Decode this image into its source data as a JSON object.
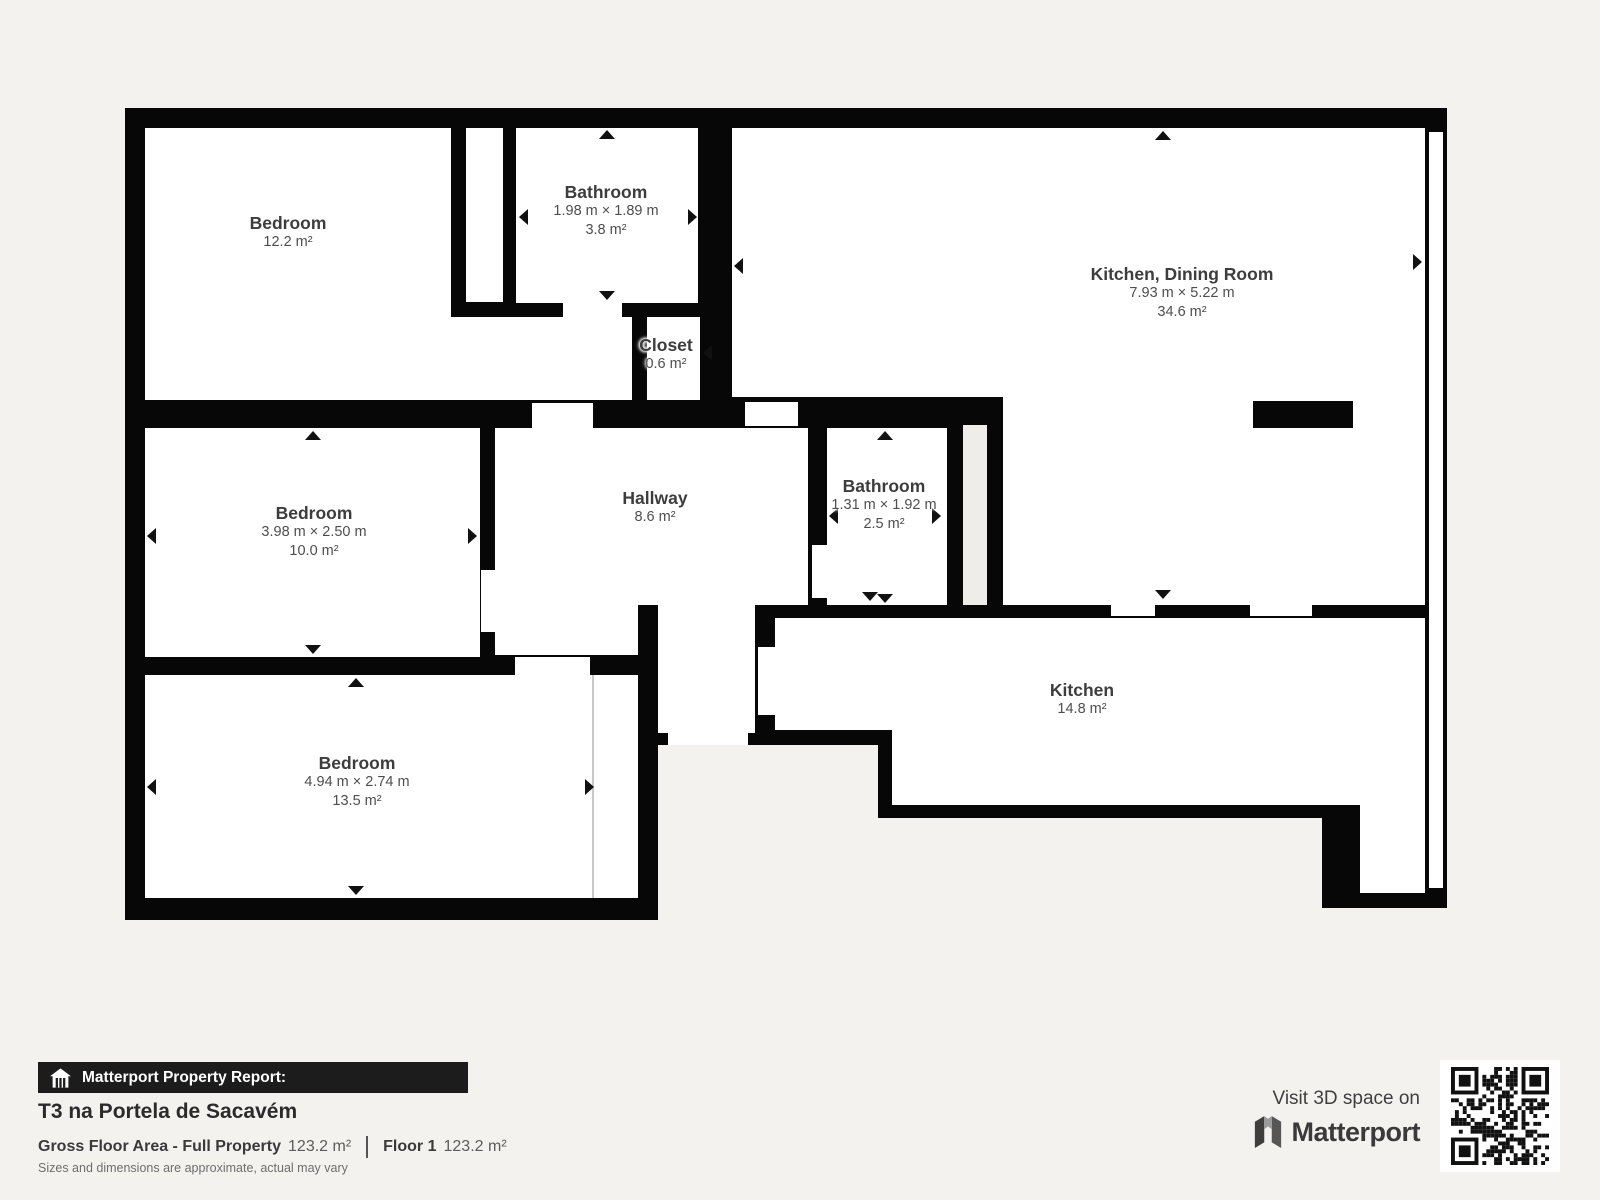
{
  "plan": {
    "rooms": {
      "bedroom_top": {
        "name": "Bedroom",
        "area": "12.2 m²"
      },
      "bathroom_top": {
        "name": "Bathroom",
        "dims": "1.98 m × 1.89 m",
        "area": "3.8 m²"
      },
      "kitchen_dining": {
        "name": "Kitchen, Dining Room",
        "dims": "7.93 m × 5.22 m",
        "area": "34.6 m²"
      },
      "closet": {
        "name": "Closet",
        "area": "0.6 m²"
      },
      "bedroom_mid": {
        "name": "Bedroom",
        "dims": "3.98 m × 2.50 m",
        "area": "10.0 m²"
      },
      "hallway": {
        "name": "Hallway",
        "area": "8.6 m²"
      },
      "bathroom_mid": {
        "name": "Bathroom",
        "dims": "1.31 m × 1.92 m",
        "area": "2.5 m²"
      },
      "kitchen": {
        "name": "Kitchen",
        "area": "14.8 m²"
      },
      "bedroom_bottom": {
        "name": "Bedroom",
        "dims": "4.94 m × 2.74 m",
        "area": "13.5 m²"
      }
    },
    "colors": {
      "wall": "#070707",
      "room": "#ffffff",
      "background": "#f4f2ef",
      "shaft": "#efedea",
      "label": "#3d3d3d"
    }
  },
  "footer": {
    "report_label": "Matterport Property Report:",
    "title": "T3 na Portela de Sacavém",
    "gfa_label": "Gross Floor Area - Full Property",
    "gfa_value": "123.2 m²",
    "floor_label": "Floor 1",
    "floor_value": "123.2 m²",
    "disclaimer": "Sizes and dimensions are approximate, actual may vary"
  },
  "cta": {
    "visit_text": "Visit 3D space on",
    "brand": "Matterport"
  }
}
